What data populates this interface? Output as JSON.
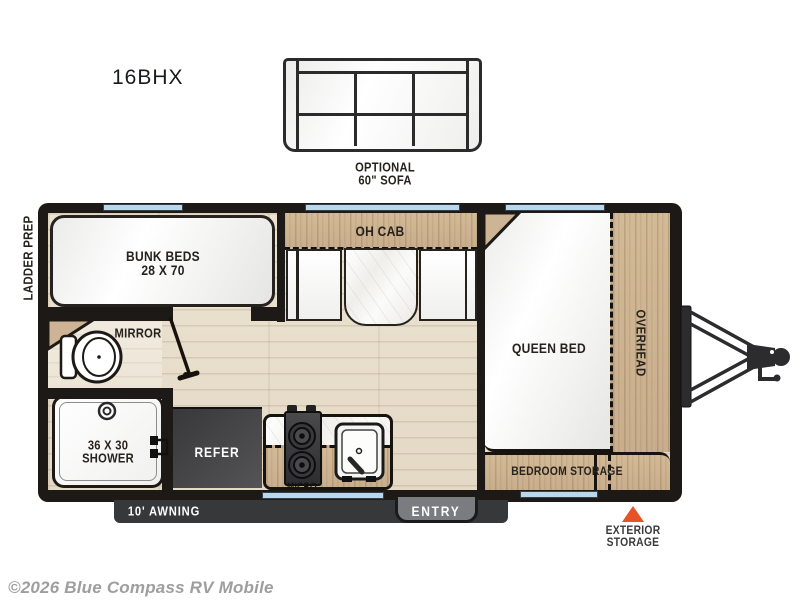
{
  "title": {
    "model": "16BHX"
  },
  "optional_sofa": {
    "line1": "OPTIONAL",
    "line2": "60\" SOFA"
  },
  "exterior": {
    "ladder_prep": "LADDER PREP",
    "awning": "10' AWNING",
    "entry": "ENTRY",
    "exterior_storage_line1": "EXTERIOR",
    "exterior_storage_line2": "STORAGE"
  },
  "rooms": {
    "bunk_line1": "BUNK BEDS",
    "bunk_line2": "28 X 70",
    "oh_cab": "OH CAB",
    "mirror": "MIRROR",
    "queen_bed": "QUEEN BED",
    "overhead": "OVERHEAD",
    "shower_line1": "36 X 30",
    "shower_line2": "SHOWER",
    "refer": "REFER",
    "micro": "MICRO",
    "bedroom_storage": "BEDROOM STORAGE"
  },
  "footer": {
    "copyright": "©2026 Blue Compass RV Mobile"
  },
  "colors": {
    "wall": "#1d1916",
    "wood": "#cdb494",
    "floor": "#e9e0cf",
    "window": "#b7d8ee",
    "awning_bar": "#37383a",
    "entry_tab": "#7b7c7f",
    "refer_box": "#47474a",
    "exterior_marker": "#e75226",
    "copyright_gray": "#9e9e9e"
  }
}
